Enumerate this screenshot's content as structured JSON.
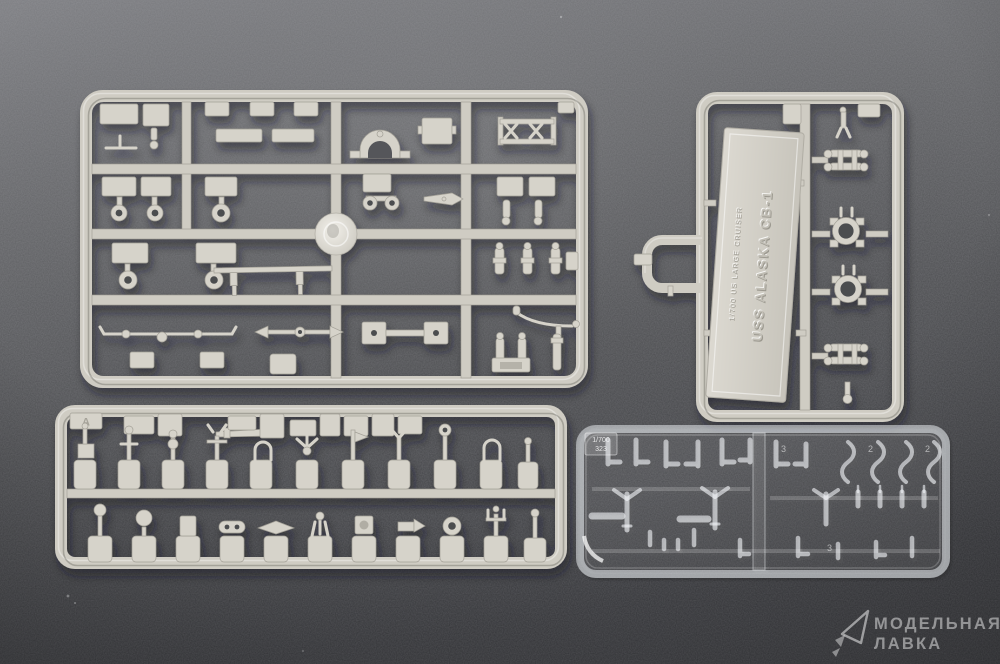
{
  "nameplate": {
    "title": "USS ALASKA CB-1",
    "subtitle": "1/700 US LARGE CRUISER"
  },
  "clear_sprue": {
    "scale_tag": "1/700",
    "code_tag": "323",
    "part_numbers": [
      "3",
      "2",
      "2",
      "3"
    ]
  },
  "gray_strip_sprue": {
    "corner_tag": "A"
  },
  "watermark": {
    "line1": "МОДЕЛЬНАЯ",
    "line2": "ЛАВКА"
  },
  "colors": {
    "background_top": "#7b7c80",
    "background_bottom": "#3c3d41",
    "plastic": "#d3d0c7",
    "plastic_highlight": "#eceae3",
    "plastic_shadow": "#a09d94",
    "clear_plastic_edge": "rgba(248,250,253,0.55)",
    "watermark_text": "rgba(255,255,255,0.48)"
  }
}
